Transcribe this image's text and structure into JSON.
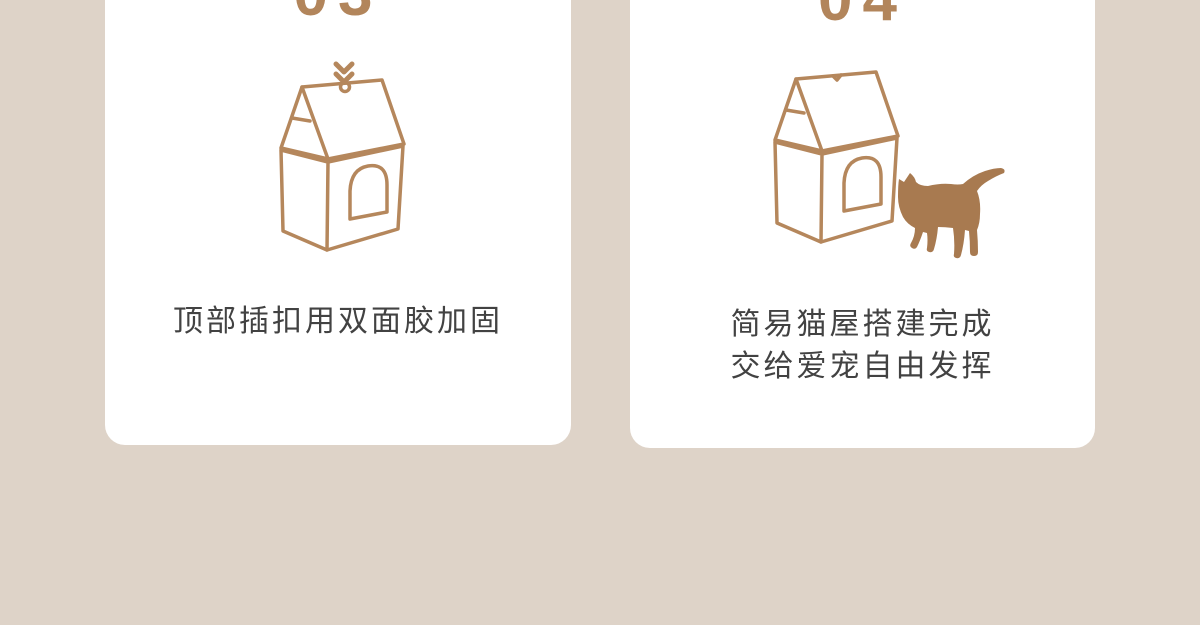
{
  "page": {
    "description_visible_content_only": "two step cards of a cat-house assembly infographic",
    "colors": {
      "background": "#ded3c8",
      "card": "#ffffff",
      "accent_brown": "#b2855b",
      "line_art_brown": "#b5875c",
      "cat_brown": "#a87a50",
      "caption_text": "#424242"
    }
  },
  "steps": [
    {
      "number": "03",
      "caption_lines": [
        "顶部插扣用双面胶加固"
      ],
      "icons": [
        "chevron-double-down-icon",
        "cat-house-outline-icon",
        "buckle-ring-icon"
      ]
    },
    {
      "number": "04",
      "caption_lines": [
        "简易猫屋搭建完成",
        "交给爱宠自由发挥"
      ],
      "icons": [
        "cat-house-outline-icon",
        "cat-silhouette-icon"
      ]
    }
  ]
}
